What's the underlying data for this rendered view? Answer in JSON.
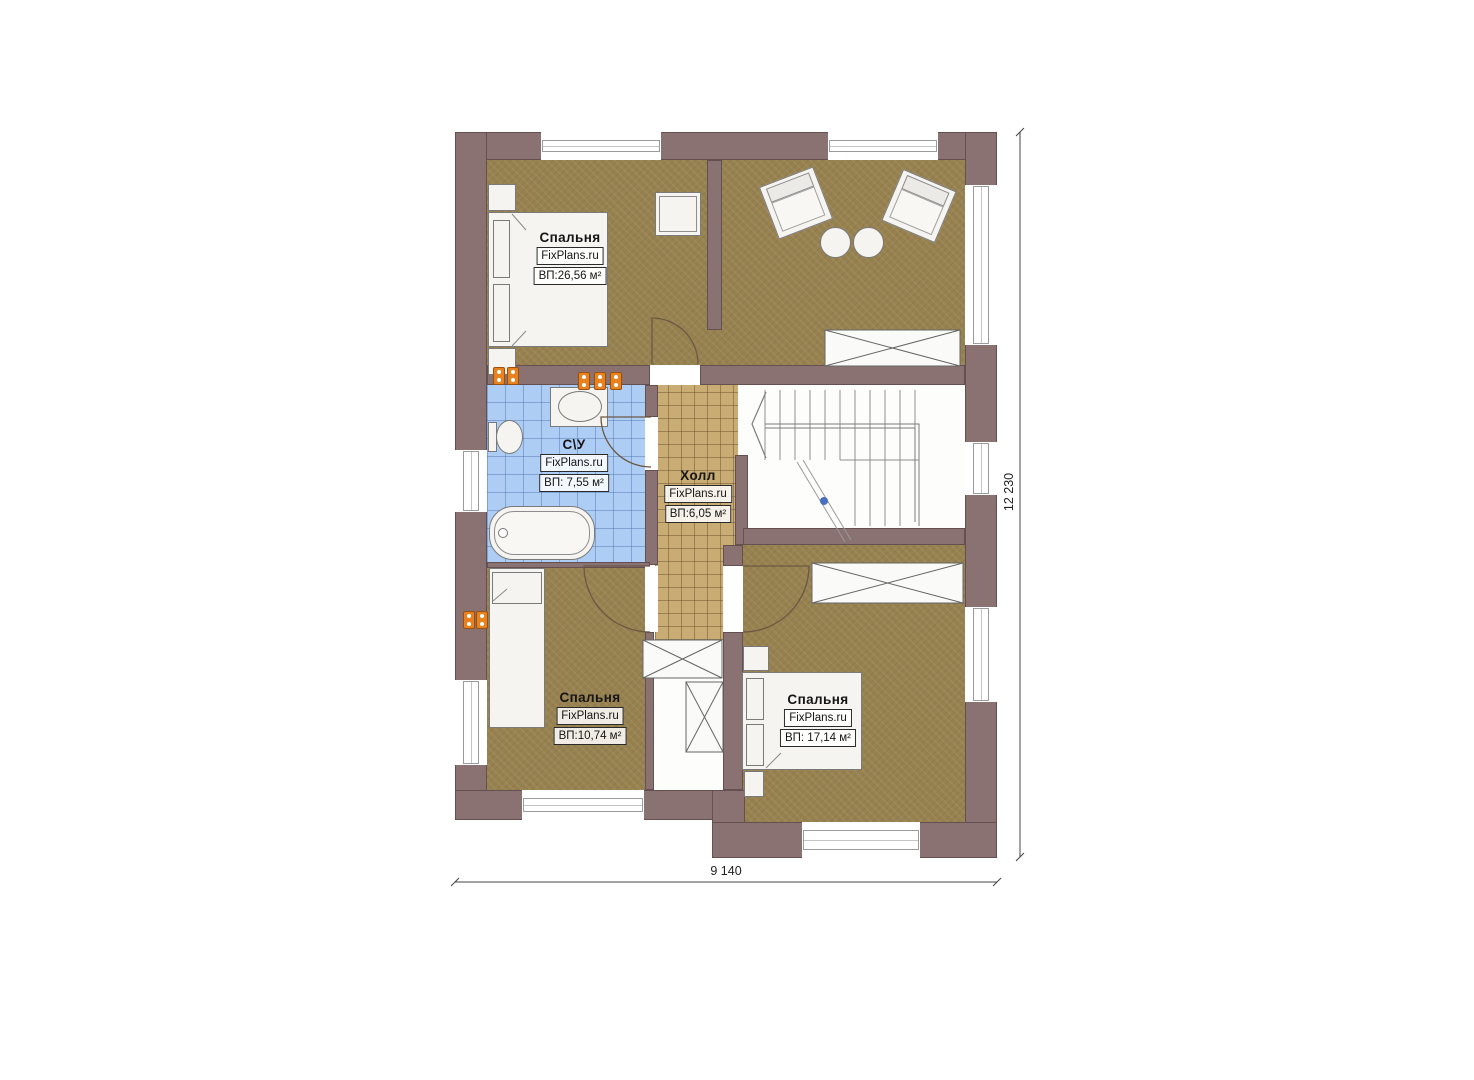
{
  "rooms": [
    {
      "name": "Спальня",
      "brand": "FixPlans.ru",
      "area": "ВП:26,56 м²"
    },
    {
      "name": "С\\У",
      "brand": "FixPlans.ru",
      "area": "ВП: 7,55 м²"
    },
    {
      "name": "Холл",
      "brand": "FixPlans.ru",
      "area": "ВП:6,05 м²"
    },
    {
      "name": "Спальня",
      "brand": "FixPlans.ru",
      "area": "ВП:10,74 м²"
    },
    {
      "name": "Спальня",
      "brand": "FixPlans.ru",
      "area": "ВП: 17,14 м²"
    }
  ],
  "dimensions": {
    "width": "9 140",
    "height": "12 230"
  },
  "colors": {
    "wall": "#8a7273",
    "wall_edge": "#645051",
    "floor_room": "#97814f",
    "floor_hall": "#c9ac74",
    "floor_bath": "#aecdf4",
    "fixture_accent": "#e8821e"
  }
}
